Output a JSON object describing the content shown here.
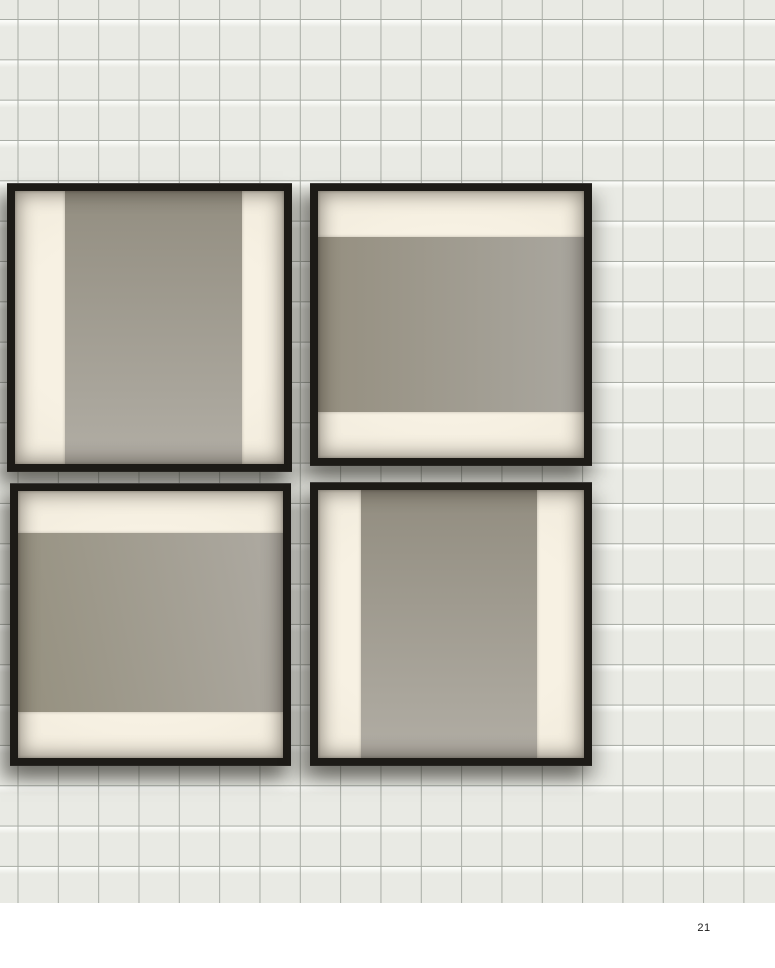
{
  "page": {
    "number": "21"
  },
  "theme": {
    "paper": "#ffffff",
    "wall-base": "#e9eae4",
    "grid-line": "#a8aca5",
    "frame-black": "#1d1b17",
    "cream-bright": "#f7f1e3",
    "cream-mid": "#efe9da",
    "cream-dim": "#ddd6c6",
    "taupe-dark": "#938e81",
    "taupe-light": "#b1ada4",
    "folio-color": "#1b1b1b"
  },
  "wall": {
    "grid_cell_size_px": 40
  },
  "artworks": [
    {
      "position": "top-left",
      "composition": "vertical gray band on cream field"
    },
    {
      "position": "top-right",
      "composition": "horizontal gray band on cream field"
    },
    {
      "position": "bottom-left",
      "composition": "horizontal gray band on cream field"
    },
    {
      "position": "bottom-right",
      "composition": "vertical gray band on cream field"
    }
  ]
}
